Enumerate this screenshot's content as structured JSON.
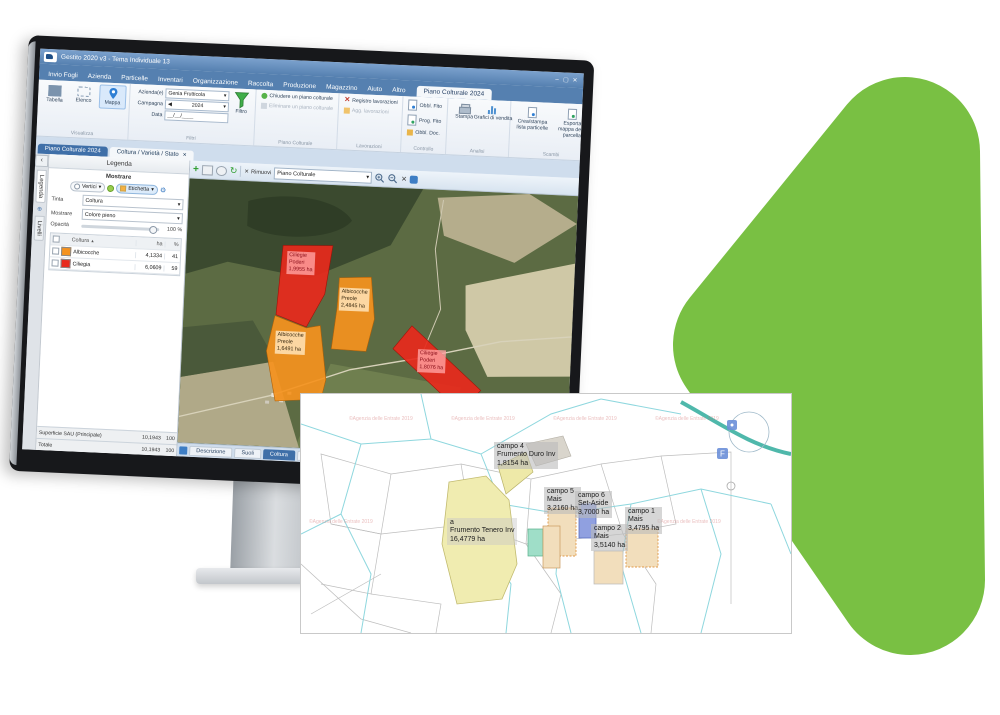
{
  "ui": {
    "caret": "▾",
    "sort_icon": "▲",
    "close_icon": "✕",
    "plus_icon": "+",
    "refresh_icon": "↻",
    "gear_icon": "⚙",
    "collapse_icon": "‹",
    "globe_icon": "⊕",
    "spin_left": "◀",
    "minimize": "–",
    "maximize": "▢"
  },
  "colors": {
    "green_shape": "#79c043",
    "albicocche_swatch": "#f5921e",
    "ciliegia_swatch": "#e8291c",
    "ribbon_blue": "#5580b0"
  },
  "app": {
    "title": "Gestito 2020 v3 - Tema Individuale 13",
    "menu_tabs": [
      "Invio Fogli",
      "Azienda",
      "Particelle",
      "Inventari",
      "Organizzazione",
      "Raccolta",
      "Produzione",
      "Magazzino",
      "Aiuto",
      "Altro"
    ],
    "active_menu_tab": "Piano Colturale 2024",
    "ribbon": {
      "visualizza": {
        "label": "Visualizza",
        "tabella": "Tabella",
        "elenco": "Elenco",
        "mappa": "Mappa"
      },
      "filtri": {
        "label": "Filtri",
        "azienda_label": "Azienda(e)",
        "azienda_value": "Genia Frutticola",
        "campagna_label": "Campagna",
        "campagna_value": "2024",
        "data_label": "Data",
        "data_value": "__/__/____",
        "filtro": "Filtro"
      },
      "piano": {
        "label": "Piano Colturale",
        "btn1": "Chiudere un piano colturale",
        "btn2": "Eliminare un piano colturale"
      },
      "lavorazioni": {
        "label": "Lavorazioni",
        "btn1": "Registro lavorazioni",
        "btn2": "Agg. lavorazioni"
      },
      "controllo": {
        "label": "Controllo",
        "btn1": "Obbl. Fito",
        "btn2": "Prog. Fito",
        "btn3": "Obbl. Doc."
      },
      "analisi": {
        "label": "Analisi",
        "btn1": "Stampa",
        "btn2": "Grafici di vendita"
      },
      "scambi": {
        "label": "Scambi",
        "btn1": "Crea/stampa lista particelle",
        "btn2": "Esporta mappa della parcella"
      },
      "impostazioni": {
        "label": "Impostazioni",
        "btn1": "Preferenze"
      }
    },
    "doc_tabs": {
      "active": "Piano Colturale 2024",
      "second": "Coltura / Varietà / Stato"
    },
    "side_tabs": {
      "legenda": "Legenda",
      "livelli": "Livelli"
    },
    "legend": {
      "title": "Legenda",
      "mostrare": "Mostrare",
      "toggle1": "Vertici",
      "toggle2": "Etichetta",
      "tinta_label": "Tinta",
      "tinta_value": "Coltura",
      "mostrare2_label": "Mostrare",
      "mostrare2_value": "Colore pieno",
      "opacita_label": "Opacità",
      "opacita_value": "100 %",
      "col_coltura": "Coltura",
      "col_ha": "ha",
      "col_pct": "%",
      "rows": [
        {
          "name": "Albicocche",
          "ha": "4,1334",
          "pct": "41",
          "color": "#f5921e"
        },
        {
          "name": "Ciliegia",
          "ha": "6,0609",
          "pct": "59",
          "color": "#e8291c"
        }
      ],
      "summary": [
        {
          "label": "Superficie SAU (Principale)",
          "ha": "10,1943",
          "pct": "100"
        },
        {
          "label": "Totale",
          "ha": "10,1943",
          "pct": "100"
        }
      ]
    },
    "map_toolbar": {
      "rimuovi": "Rimuovi",
      "layer": "Piano Colturale"
    },
    "bottom_tabs": [
      "Descrizione",
      "Suoli",
      "Coltura",
      "Storia",
      "Ambiente"
    ],
    "fields": [
      {
        "crop": "Ciliegie",
        "farm": "Poderi",
        "area": "1,9955 ha"
      },
      {
        "crop": "Albicocche",
        "farm": "Preole",
        "area": "2,4845 ha"
      },
      {
        "crop": "Albicocche",
        "farm": "Preole",
        "area": "1,6491 ha"
      },
      {
        "crop": "Ciliegie",
        "farm": "Poderi",
        "area": "1,8076 ha"
      }
    ]
  },
  "overlay": {
    "watermark": "©Agenzia delle Entrate 2019",
    "icon_f": "F",
    "fields": [
      {
        "name": "campo 4",
        "crop": "Frumento Duro Inv",
        "area": "1,8154 ha"
      },
      {
        "name": "campo 5",
        "crop": "Mais",
        "area": "3,2160 ha"
      },
      {
        "name": "campo 6",
        "crop": "Set-Aside",
        "area": "3,7000 ha"
      },
      {
        "name": "campo 1",
        "crop": "Mais",
        "area": "3,4795 ha"
      },
      {
        "name": "campo 2",
        "crop": "Mais",
        "area": "3,5140 ha"
      },
      {
        "name": "a",
        "crop": "Frumento Tenero Inv",
        "area": "16,4779 ha"
      }
    ]
  }
}
